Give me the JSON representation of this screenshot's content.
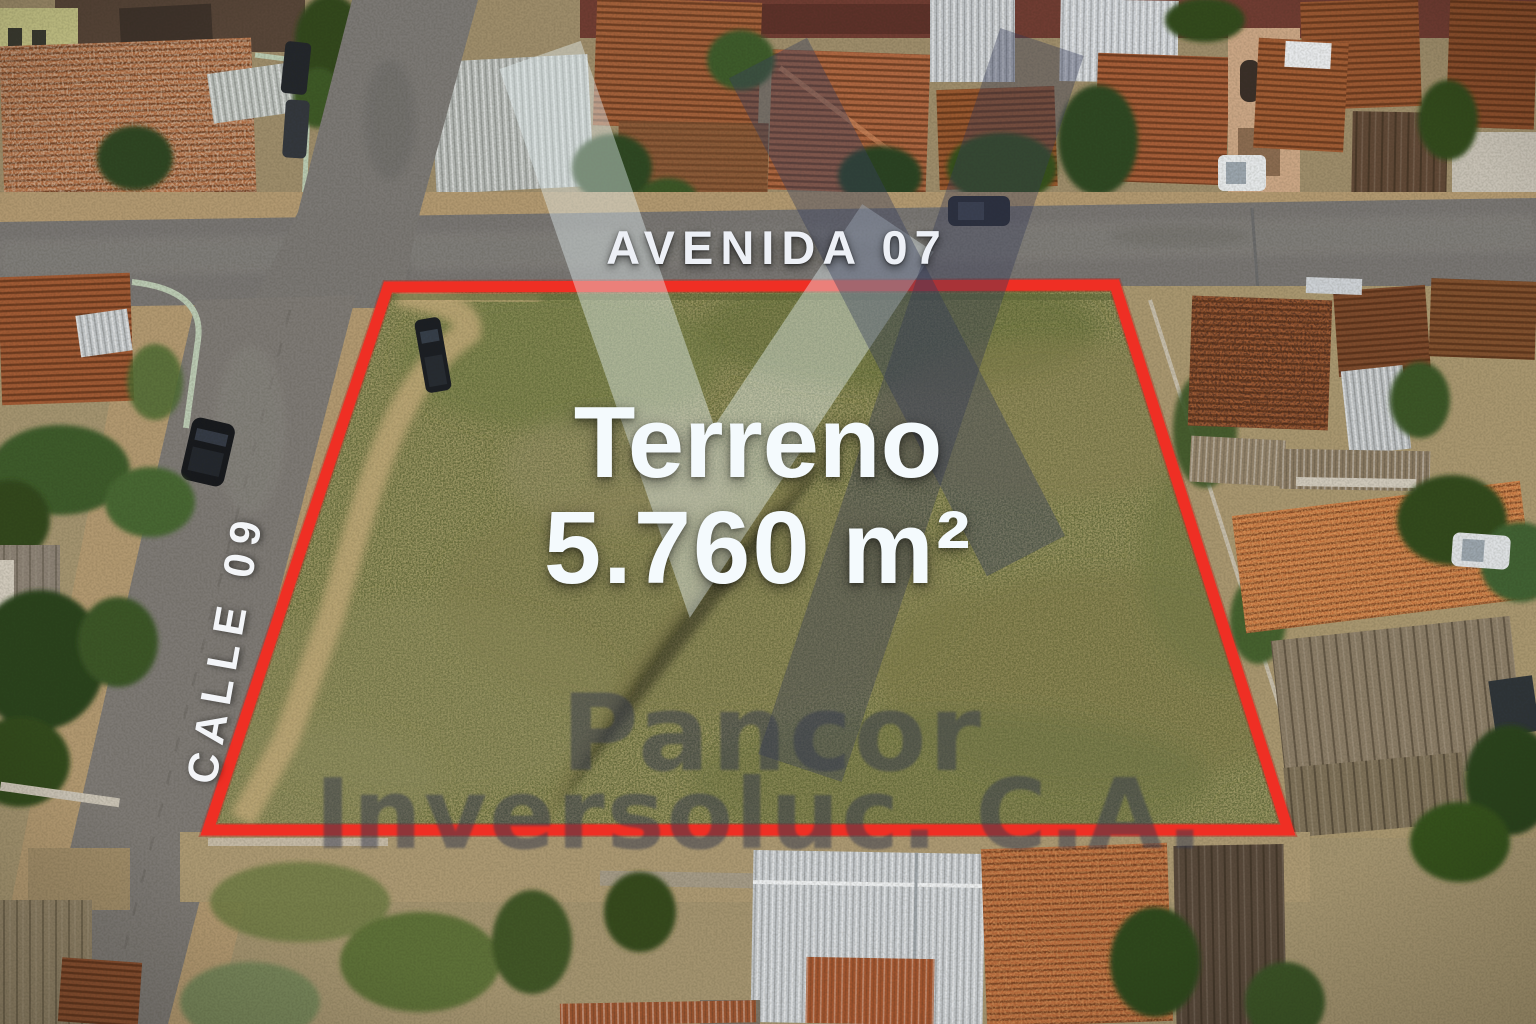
{
  "listing": {
    "avenue_label": "AVENIDA 07",
    "street_label": "CALLE 09",
    "lot": {
      "title": "Terreno",
      "area": "5.760 m²"
    },
    "watermark": {
      "company": "Pancor",
      "suffix": "Inversoluc. C.A."
    },
    "colors": {
      "boundary_red": "#ef2f24",
      "label_white": "#edf0f6",
      "watermark_text": "#383c4e",
      "logo_light": "#e4f0f4",
      "logo_dark": "#383e5c"
    }
  }
}
